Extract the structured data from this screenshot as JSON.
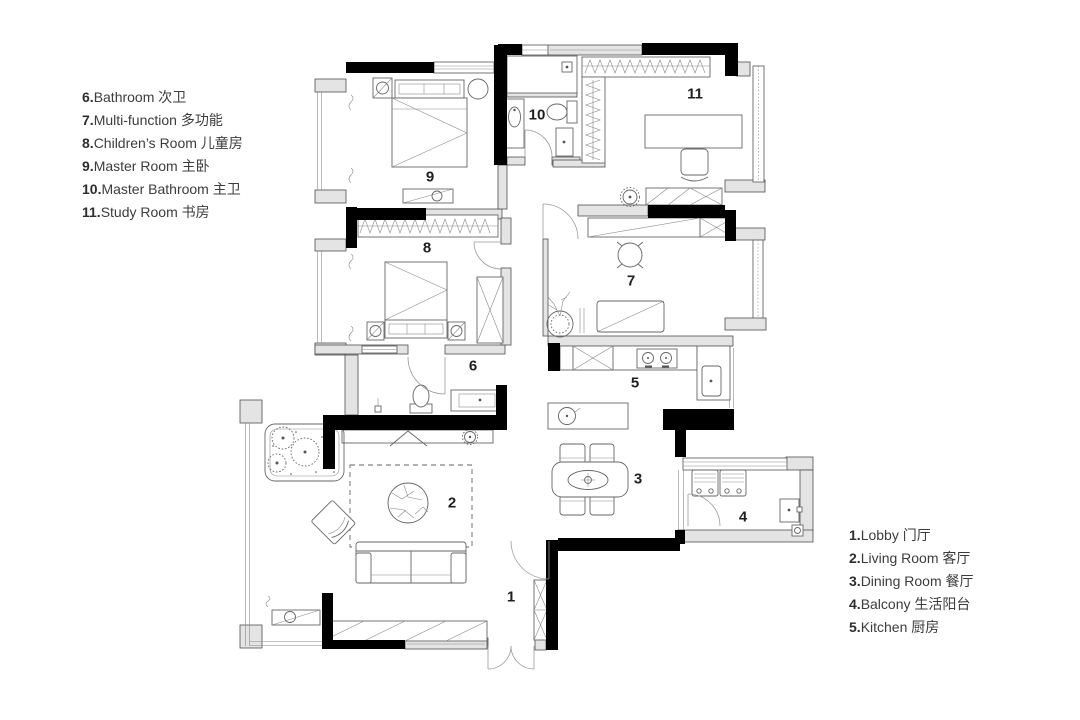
{
  "canvas": {
    "width": 1080,
    "height": 720,
    "background": "#ffffff"
  },
  "colors": {
    "wall": "#000000",
    "wall_light": "#e4e4e4",
    "furniture_line": "#666666",
    "text": "#3c3c3c",
    "label": "#1f1f1f"
  },
  "legend_left": {
    "items": [
      {
        "number": "6.",
        "label": "Bathroom 次卫"
      },
      {
        "number": "7.",
        "label": "Multi-function 多功能"
      },
      {
        "number": "8.",
        "label": "Children’s Room 儿童房"
      },
      {
        "number": "9.",
        "label": "Master Room 主卧"
      },
      {
        "number": "10.",
        "label": "Master Bathroom 主卫"
      },
      {
        "number": "11.",
        "label": "Study Room 书房"
      }
    ]
  },
  "legend_right": {
    "items": [
      {
        "number": "1.",
        "label": "Lobby 门厅"
      },
      {
        "number": "2.",
        "label": "Living Room 客厅"
      },
      {
        "number": "3.",
        "label": "Dining Room 餐厅"
      },
      {
        "number": "4.",
        "label": "Balcony 生活阳台"
      },
      {
        "number": "5.",
        "label": "Kitchen 厨房"
      }
    ]
  },
  "room_labels": {
    "lobby": "1",
    "living": "2",
    "dining": "3",
    "balcony": "4",
    "kitchen": "5",
    "bathroom": "6",
    "multifunction": "7",
    "children": "8",
    "master": "9",
    "master_bath": "10",
    "study": "11"
  }
}
